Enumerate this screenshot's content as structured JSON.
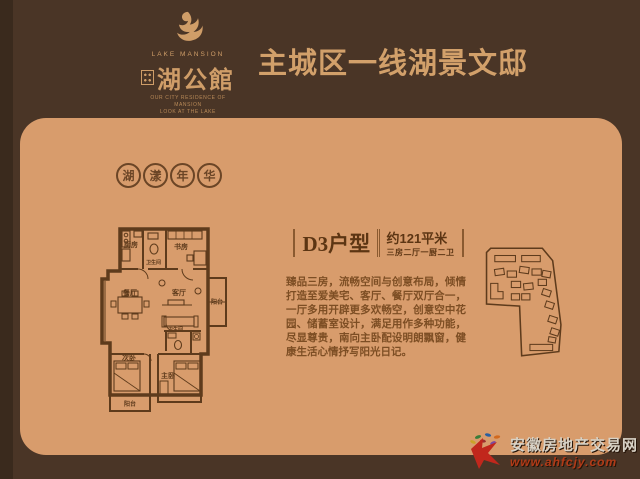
{
  "page": {
    "bg_color": "#4a3526",
    "card_color": "#d89c6c",
    "accent_color": "#d2a06a",
    "ink_color": "#5e3b1c"
  },
  "header": {
    "logo": {
      "brand_en": "LAKE MANSION",
      "brand_cn": "湖公館",
      "tagline_1": "OUR CITY RESIDENCE OF MANSION",
      "tagline_2": "LOOK AT THE LAKE"
    },
    "title": "主城区一线湖景文邸"
  },
  "card": {
    "badge": {
      "chars": [
        "湖",
        "漾",
        "年",
        "华"
      ]
    },
    "unit": {
      "name": "D3户型",
      "area": "约121平米",
      "layout": "三房二厅一厨二卫",
      "description": "臻品三房，流畅空间与创意布局，倾情打造至爱美宅、客厅、餐厅双厅合一，一厅多用开辟更多欢畅空，创意空中花园、储蓄室设计，满足用作多种功能，尽显尊贵，南向主卧配设明朗飘窗，健康生活心情抒写阳光日记。"
    },
    "floorplan": {
      "rooms": [
        "厨房",
        "卫生间",
        "书房",
        "餐厅",
        "客厅",
        "阳台",
        "次卧",
        "卫生间",
        "主卧",
        "阳台"
      ]
    }
  },
  "watermark": {
    "site_name": "安徽房地产交易网",
    "site_url": "www.ahfcjy.com"
  }
}
